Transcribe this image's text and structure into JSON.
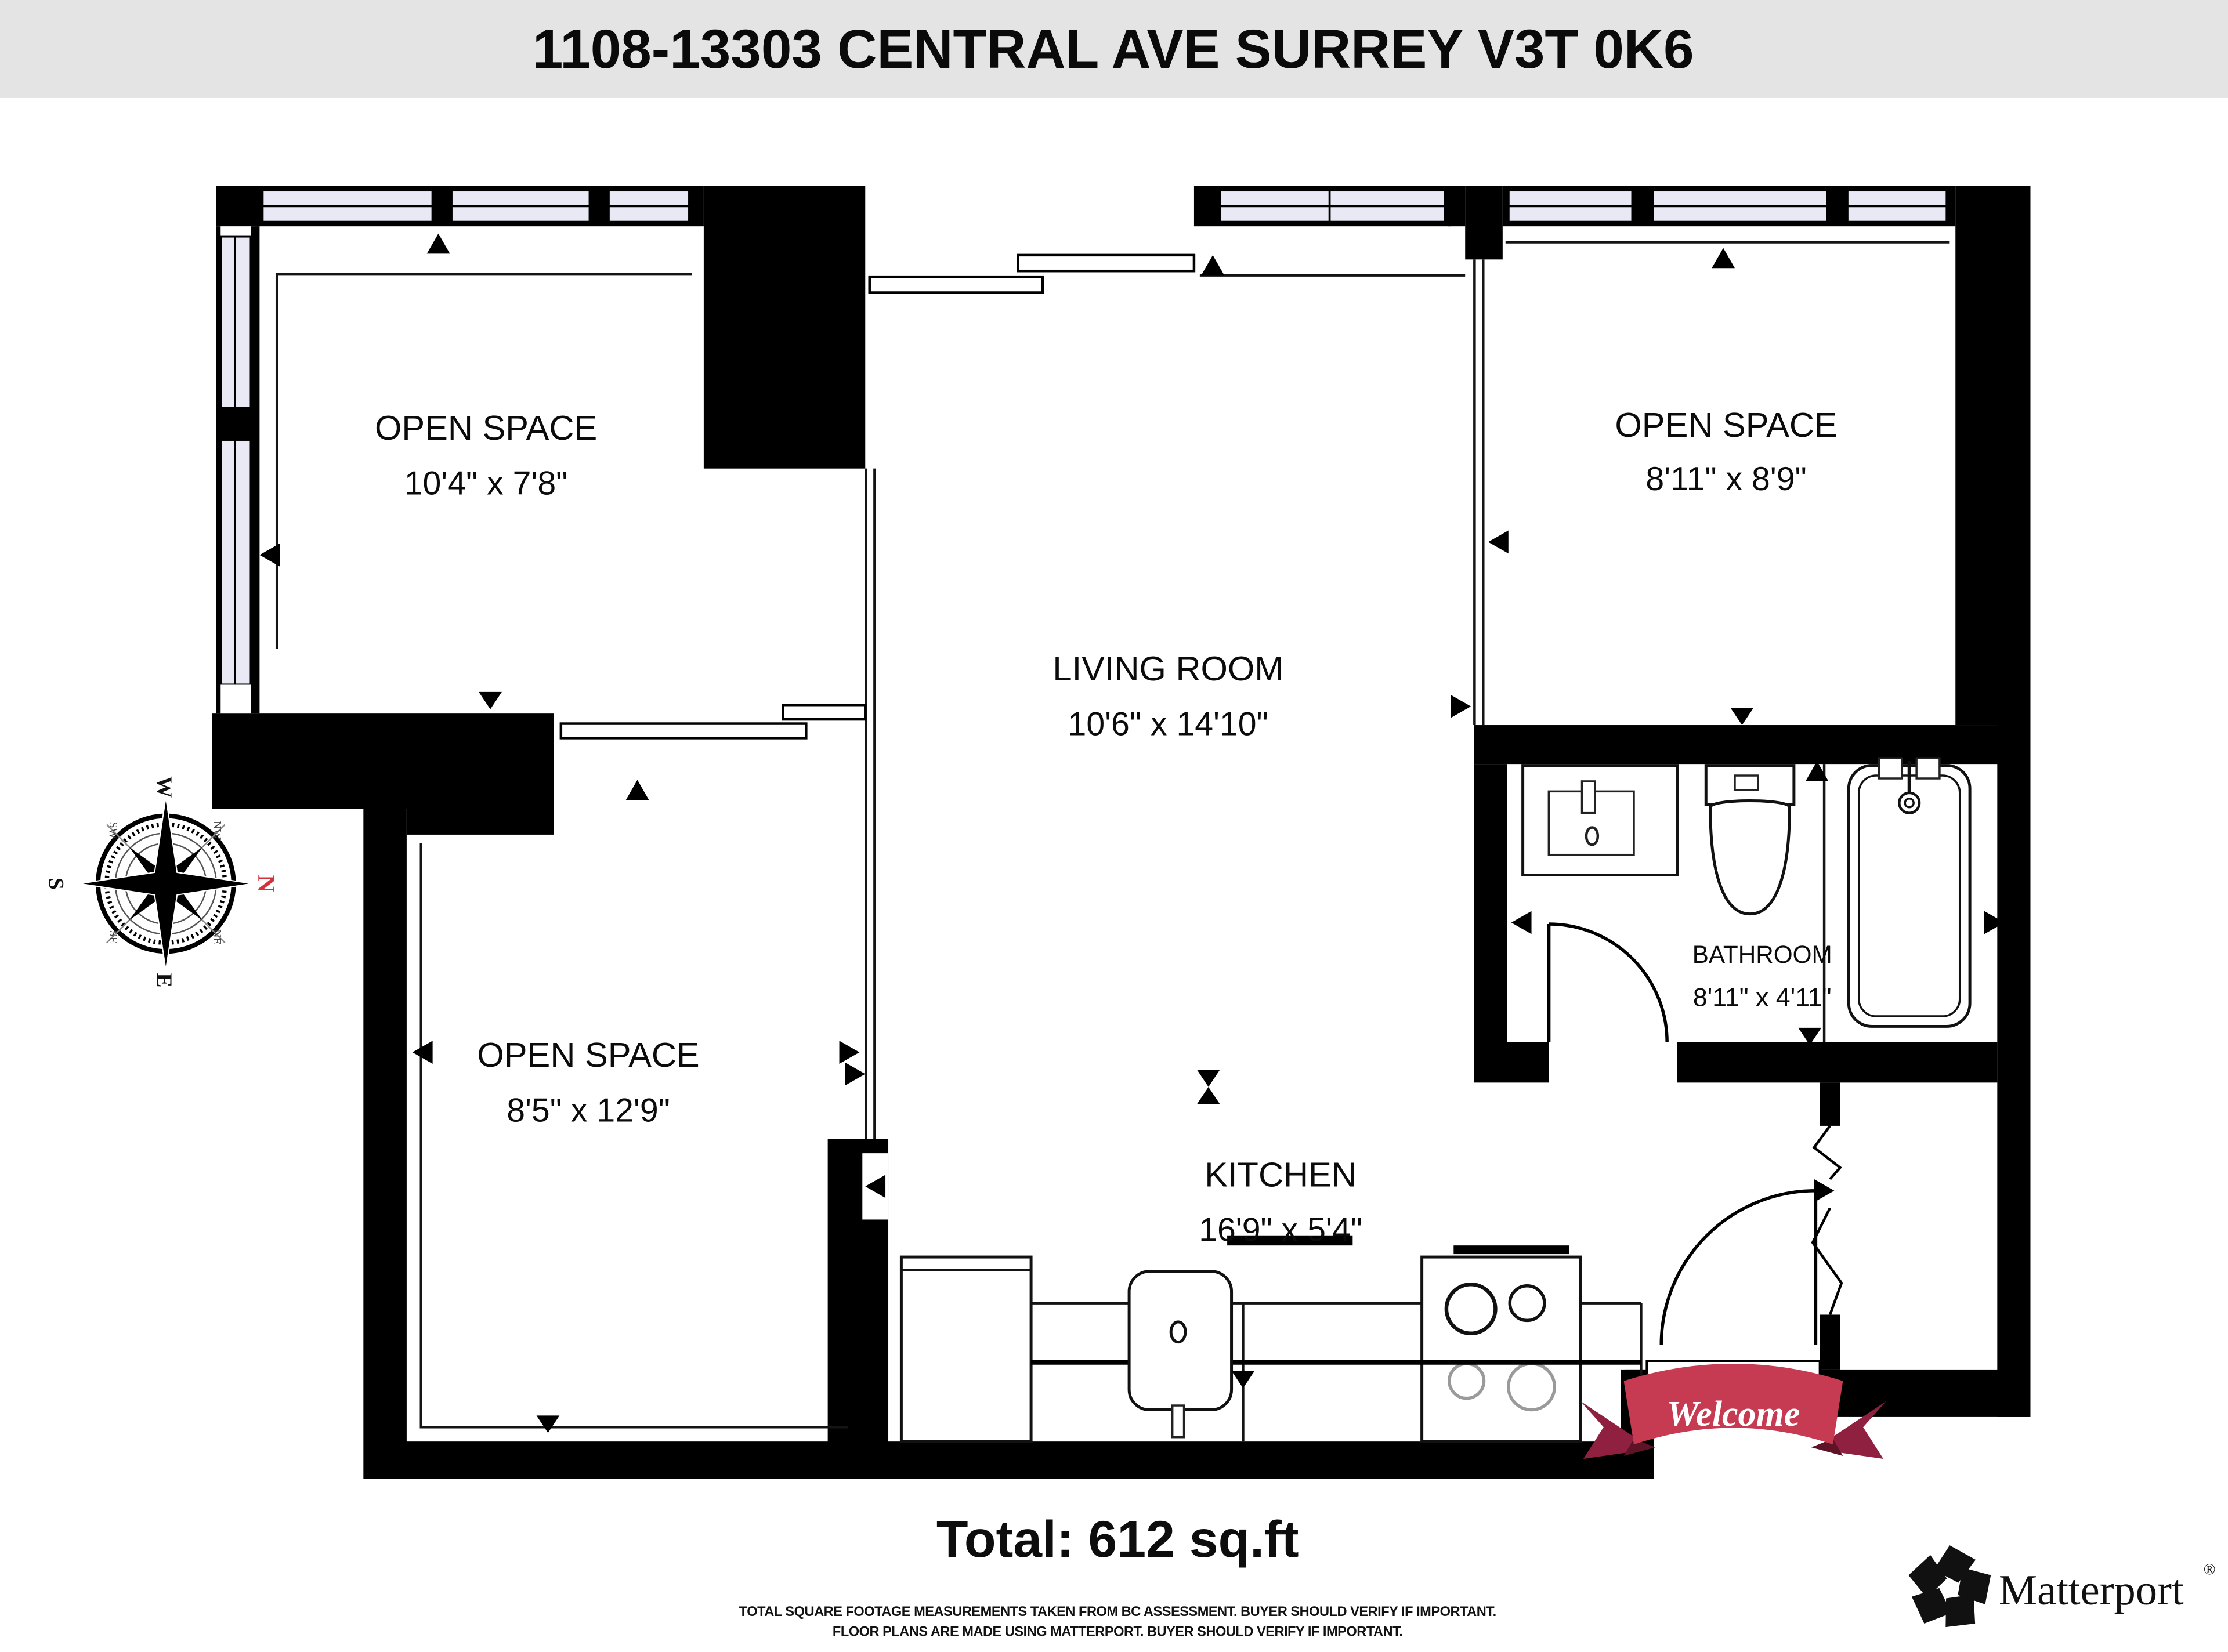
{
  "header": {
    "title": "1108-13303 CENTRAL AVE SURREY V3T 0K6"
  },
  "rooms": [
    {
      "name": "OPEN SPACE",
      "dims": "10'4\" x 7'8\""
    },
    {
      "name": "OPEN SPACE",
      "dims": "8'11\" x 8'9\""
    },
    {
      "name": "LIVING ROOM",
      "dims": "10'6\" x 14'10\""
    },
    {
      "name": "OPEN SPACE",
      "dims": "8'5\" x 12'9\""
    },
    {
      "name": "BATHROOM",
      "dims": "8'11\" x 4'11\""
    },
    {
      "name": "KITCHEN",
      "dims": "16'9\" x 5'4\""
    }
  ],
  "compass": {
    "n": "N",
    "w": "W",
    "s": "S",
    "e": "E",
    "nw": "NW",
    "ne": "NE",
    "sw": "SW",
    "se": "SE"
  },
  "entry_banner": {
    "text": "Welcome"
  },
  "footer": {
    "total": "Total: 612 sq.ft",
    "disclaimer_line1": "TOTAL SQUARE FOOTAGE MEASUREMENTS TAKEN FROM BC ASSESSMENT. BUYER SHOULD VERIFY IF IMPORTANT.",
    "disclaimer_line2": "FLOOR PLANS ARE MADE USING MATTERPORT. BUYER SHOULD VERIFY IF IMPORTANT.",
    "brand": "Matterport",
    "registered_mark": "®"
  },
  "colors": {
    "wall": "#000000",
    "window_pane": "#e9e9f6",
    "header_bg": "#e4e4e4",
    "banner_red": "#c63b52",
    "banner_red_dark": "#8f2040",
    "compass_north_red": "#d3323d"
  }
}
